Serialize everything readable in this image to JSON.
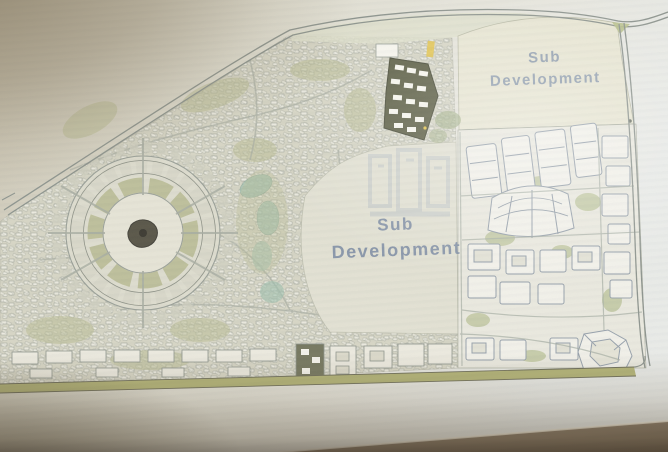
{
  "labels": {
    "parcel_top_right": {
      "line1": "Sub",
      "line2": "Development"
    },
    "parcel_center": {
      "line1": "Sub",
      "line2": "Development"
    }
  },
  "colors": {
    "paper": "#e4e2d6",
    "paper_shadowed": "#b8ac94",
    "table_surface": "#8a7a65",
    "road_line": "#8e958f",
    "residential_base": "#d6d5c5",
    "greenery": "#b5b88e",
    "water_park": "#9fbfae",
    "highlighted_parcel": "#5f6147",
    "highlight_buildings": "#f7f6ee",
    "marker_yellow": "#e3c44e",
    "label_text": "#7e8ea6",
    "watermark_blue": "#5a77a8",
    "plaza_center": "#595648"
  }
}
